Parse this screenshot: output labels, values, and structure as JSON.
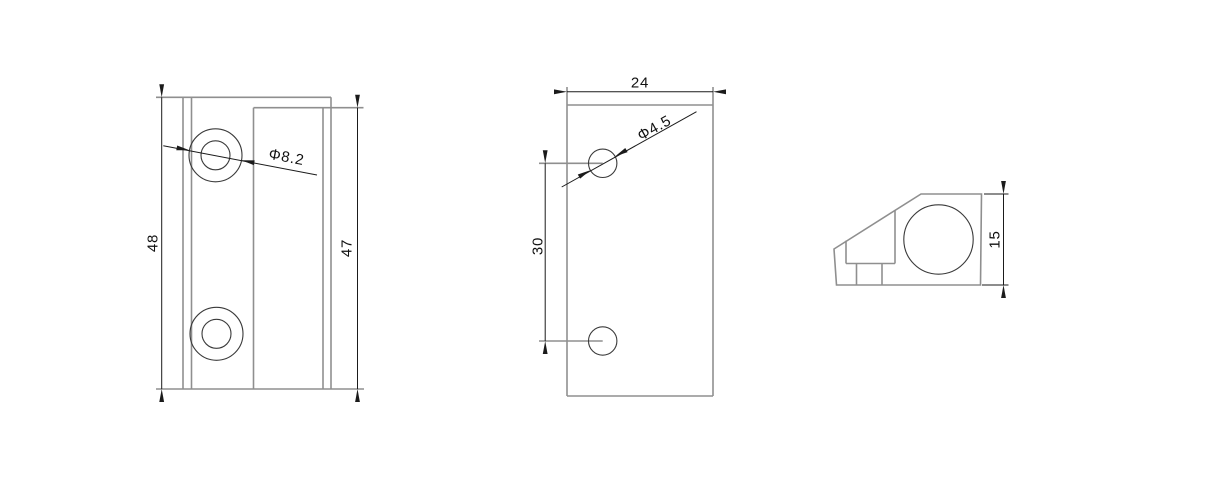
{
  "views": {
    "front": {
      "overall_height": "48",
      "inner_height": "47",
      "hole_callout": "Φ8.2"
    },
    "side": {
      "width": "24",
      "hole_spacing": "30",
      "hole_callout": "Φ4.5"
    },
    "end": {
      "height": "15"
    }
  },
  "colors": {
    "background": "#ffffff",
    "part_line": "#8f8f8f",
    "hole_line": "#3a3a3a",
    "dimension_line": "#1b1b1b",
    "text": "#111111"
  }
}
